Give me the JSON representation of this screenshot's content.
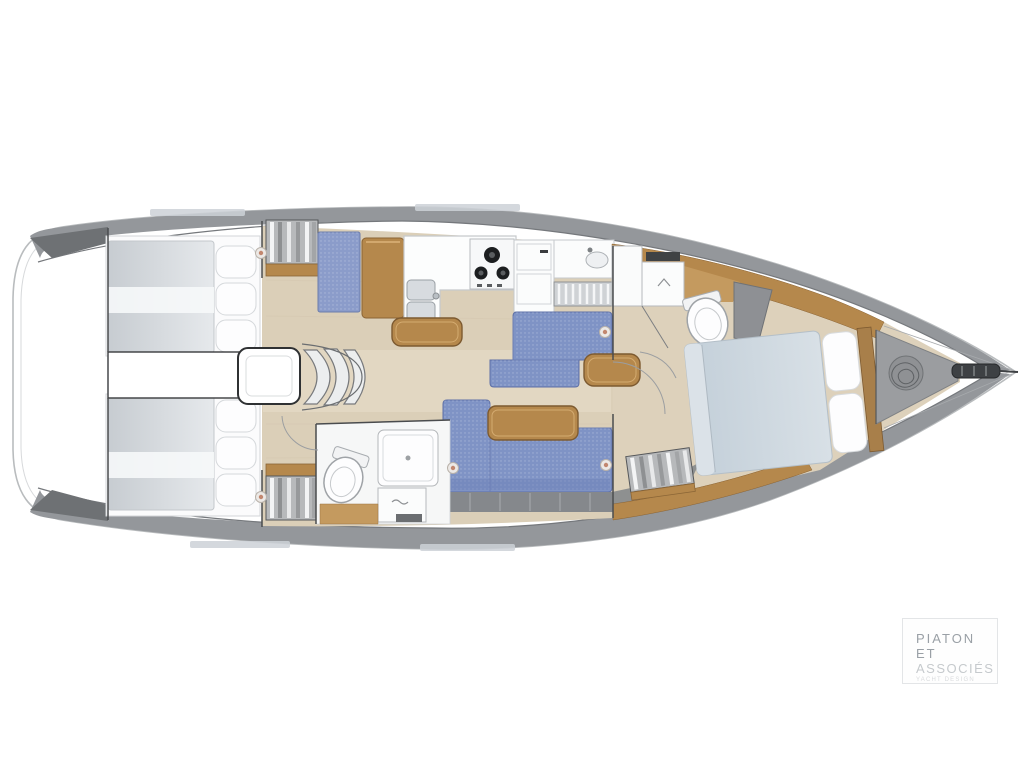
{
  "page": {
    "background": "#ffffff",
    "width": 1024,
    "height": 768
  },
  "logo": {
    "line1": "PIATON",
    "line2": "ET",
    "line3": "ASSOCIÉS",
    "tagline": "YACHT DESIGN"
  },
  "plan": {
    "type": "sailboat-interior-layout",
    "orientation": "bow-right",
    "features": [
      "stern-swim-platform",
      "aft-cabin-starboard-bed",
      "aft-cabin-port-bed",
      "engine-box",
      "companionway-steps",
      "wardrobe-hanging-lockers",
      "nav-seat",
      "chart-table",
      "galley-double-sink",
      "galley-stove",
      "galley-fridge",
      "galley-louver-rack",
      "galley-wood-bar",
      "salon-sofa-starboard",
      "salon-sofa-port",
      "salon-wood-tables",
      "aft-head-toilet",
      "aft-head-shower",
      "aft-head-sink",
      "forward-head-toilet",
      "forward-head-sink",
      "forward-head-shower-wall",
      "forward-cabin-double-bed",
      "forward-wardrobe",
      "anchor-locker",
      "anchor-rope",
      "bow-fitting"
    ]
  },
  "colors": {
    "hull_outline": "#b9bcbe",
    "deck_band": "#94979b",
    "deck_wedge": "#6e7174",
    "wood": "#b5884c",
    "wood_dark": "#7d5a30",
    "floor_wood": "#dbcfb8",
    "head_floor_wood": "#c49a5f",
    "sofa_blue": "#7f93c5",
    "seat_blue": "#8b9cca",
    "mattress_gray": "#d2d6da",
    "forward_bed_blue": "#ccd6de",
    "anchor_locker_gray": "#9b9da0",
    "shower_wall_gray": "#8e9094",
    "logo_text": "#9aa0a6",
    "logo_text_light": "#c6cacd"
  }
}
